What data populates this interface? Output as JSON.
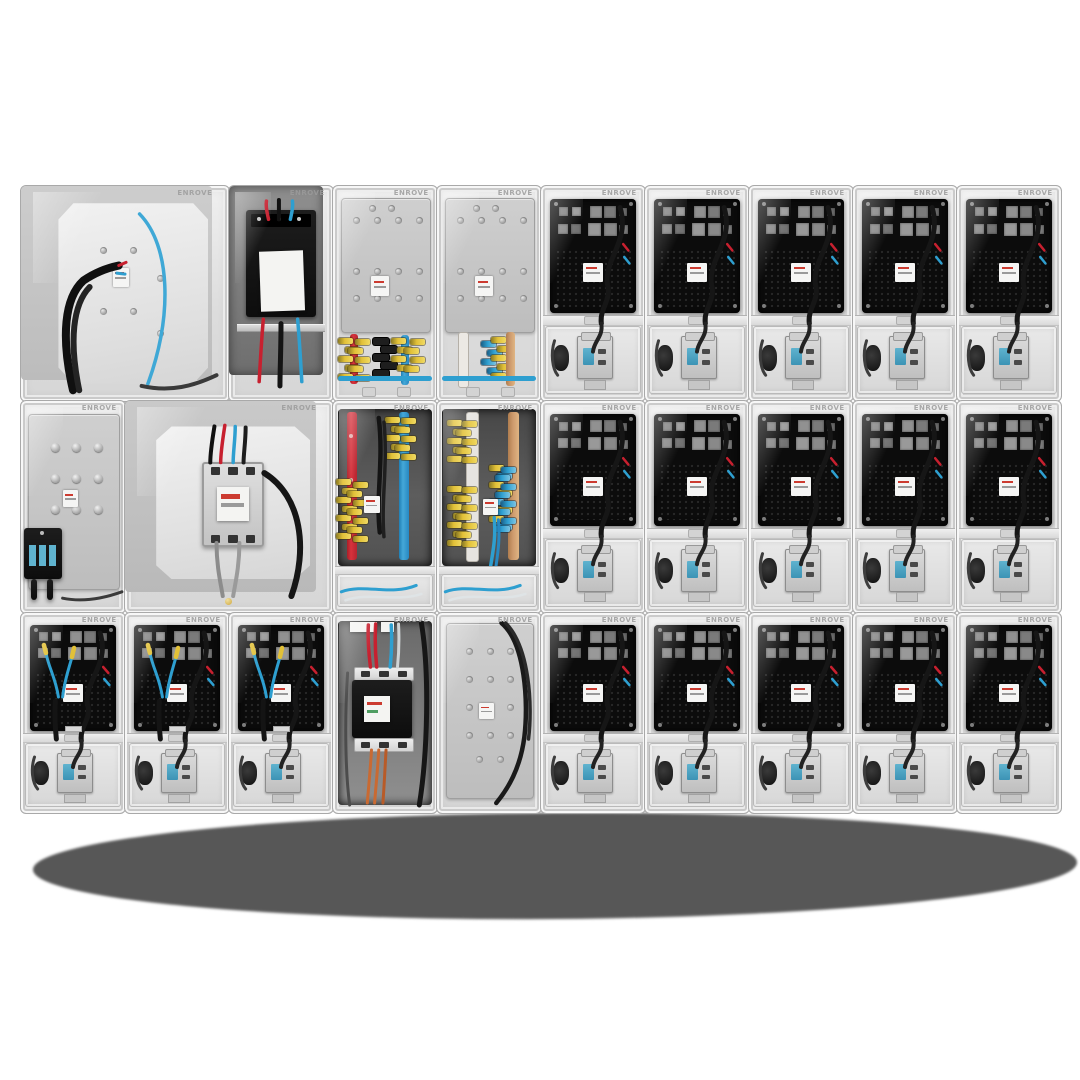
{
  "image": {
    "type": "product-photo",
    "subject": "Wall assembly of modular transparent electrical meter enclosures",
    "background_color": "#ffffff"
  },
  "brand": {
    "text": "ENROVE"
  },
  "palette": {
    "cable": "#161616",
    "plate": "#0c0c0c",
    "red": "#c7202f",
    "blue": "#2e9fd0",
    "bluelt": "#5fb3cf",
    "yellow": "#e2c138",
    "copper": "#cd9a6d",
    "markred": "#cc3b30",
    "shadow": "#575757",
    "frame": "#e4e4e4"
  },
  "grid": {
    "left": 20,
    "top": 185,
    "unit_width": 104,
    "columns": 10,
    "row_heights": [
      215,
      212,
      200
    ],
    "rows": 3,
    "total_enclosures": 28
  },
  "units": [
    {
      "id": "A1",
      "row": 0,
      "col": 0,
      "span": 2,
      "type": "service-entry"
    },
    {
      "id": "A2",
      "row": 0,
      "col": 2,
      "span": 1,
      "type": "contactor"
    },
    {
      "id": "A3",
      "row": 0,
      "col": 3,
      "span": 1,
      "type": "busbar-link-a"
    },
    {
      "id": "A4",
      "row": 0,
      "col": 4,
      "span": 1,
      "type": "busbar-link-b"
    },
    {
      "id": "A5",
      "row": 0,
      "col": 5,
      "span": 1,
      "type": "meter"
    },
    {
      "id": "A6",
      "row": 0,
      "col": 6,
      "span": 1,
      "type": "meter"
    },
    {
      "id": "A7",
      "row": 0,
      "col": 7,
      "span": 1,
      "type": "meter"
    },
    {
      "id": "A8",
      "row": 0,
      "col": 8,
      "span": 1,
      "type": "meter"
    },
    {
      "id": "A9",
      "row": 0,
      "col": 9,
      "span": 1,
      "type": "meter"
    },
    {
      "id": "B1",
      "row": 1,
      "col": 0,
      "span": 1,
      "type": "aux-plate"
    },
    {
      "id": "B2",
      "row": 1,
      "col": 1,
      "span": 2,
      "type": "main-breaker"
    },
    {
      "id": "B3",
      "row": 1,
      "col": 3,
      "span": 1,
      "type": "busbar-riser-a"
    },
    {
      "id": "B4",
      "row": 1,
      "col": 4,
      "span": 1,
      "type": "busbar-riser-b"
    },
    {
      "id": "B5",
      "row": 1,
      "col": 5,
      "span": 1,
      "type": "meter"
    },
    {
      "id": "B6",
      "row": 1,
      "col": 6,
      "span": 1,
      "type": "meter"
    },
    {
      "id": "B7",
      "row": 1,
      "col": 7,
      "span": 1,
      "type": "meter"
    },
    {
      "id": "B8",
      "row": 1,
      "col": 8,
      "span": 1,
      "type": "meter"
    },
    {
      "id": "B9",
      "row": 1,
      "col": 9,
      "span": 1,
      "type": "meter"
    },
    {
      "id": "C1",
      "row": 2,
      "col": 0,
      "span": 1,
      "type": "meter-wired"
    },
    {
      "id": "C2",
      "row": 2,
      "col": 1,
      "span": 1,
      "type": "meter-wired"
    },
    {
      "id": "C3",
      "row": 2,
      "col": 2,
      "span": 1,
      "type": "meter-wired"
    },
    {
      "id": "C4",
      "row": 2,
      "col": 3,
      "span": 1,
      "type": "breaker-column"
    },
    {
      "id": "C5",
      "row": 2,
      "col": 4,
      "span": 1,
      "type": "blank-plate"
    },
    {
      "id": "C6",
      "row": 2,
      "col": 5,
      "span": 1,
      "type": "meter"
    },
    {
      "id": "C7",
      "row": 2,
      "col": 6,
      "span": 1,
      "type": "meter"
    },
    {
      "id": "C8",
      "row": 2,
      "col": 7,
      "span": 1,
      "type": "meter"
    },
    {
      "id": "C9",
      "row": 2,
      "col": 8,
      "span": 1,
      "type": "meter"
    },
    {
      "id": "C10",
      "row": 2,
      "col": 9,
      "span": 1,
      "type": "meter"
    }
  ],
  "shadow": {
    "left": 33,
    "top": 813,
    "width": 1044,
    "height": 106,
    "color": "#575757"
  }
}
